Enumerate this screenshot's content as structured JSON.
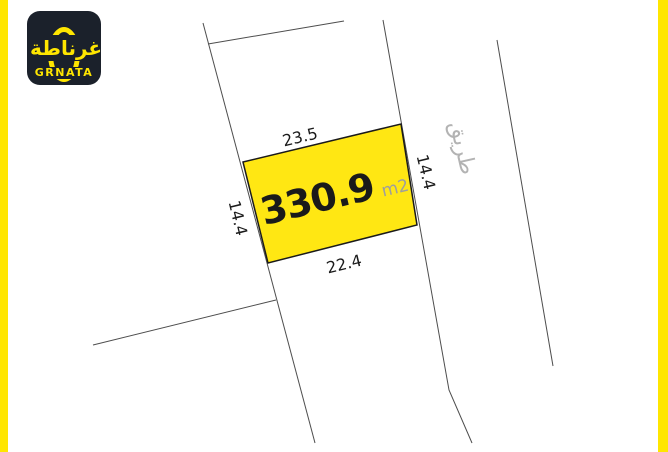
{
  "brand": {
    "logo_arabic": "غرناطة",
    "logo_latin": "GRNATA",
    "logo_bg_color": "#1b212b",
    "accent_yellow": "#ffe600"
  },
  "page": {
    "side_border_color": "#ffe600",
    "background_color": "#ffffff"
  },
  "plot": {
    "area_value": "330.9",
    "area_unit": "m2",
    "fill_color": "#ffe713",
    "dimensions": {
      "top": "23.5",
      "bottom": "22.4",
      "left": "14.4",
      "right": "14.4"
    }
  },
  "road": {
    "label_arabic": "طريق"
  }
}
